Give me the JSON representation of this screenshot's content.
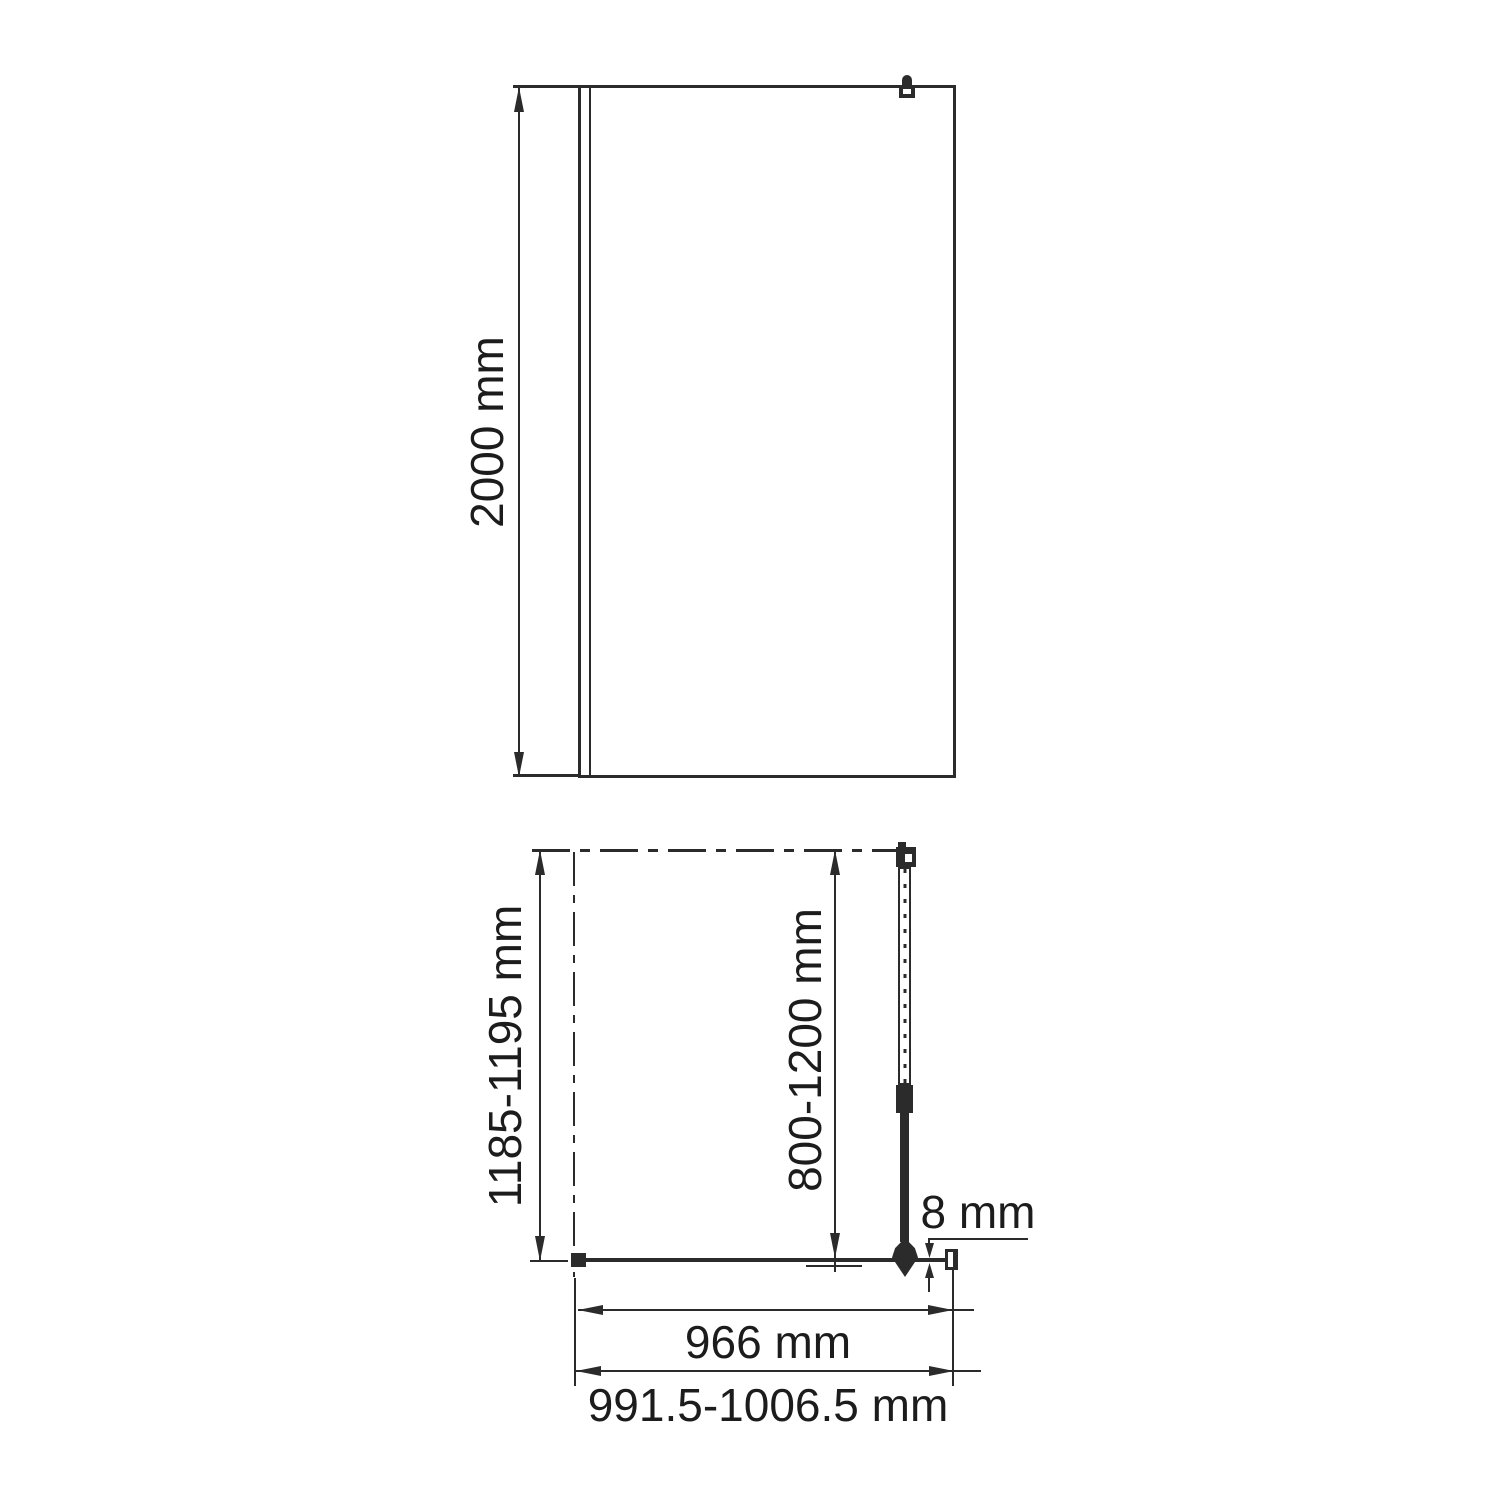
{
  "drawing": {
    "type": "technical-drawing-shower-screen",
    "front_view": {
      "height": "2000 mm"
    },
    "plan_view": {
      "depth": "1185-1195 mm",
      "support_bar_range": "800-1200 mm",
      "glass_thickness": "8 mm",
      "glass_width": "966 mm",
      "overall_width": "991.5-1006.5 mm"
    },
    "colors": {
      "line": "#2b2b2b",
      "background": "#ffffff",
      "text": "#1c1c1c"
    }
  }
}
